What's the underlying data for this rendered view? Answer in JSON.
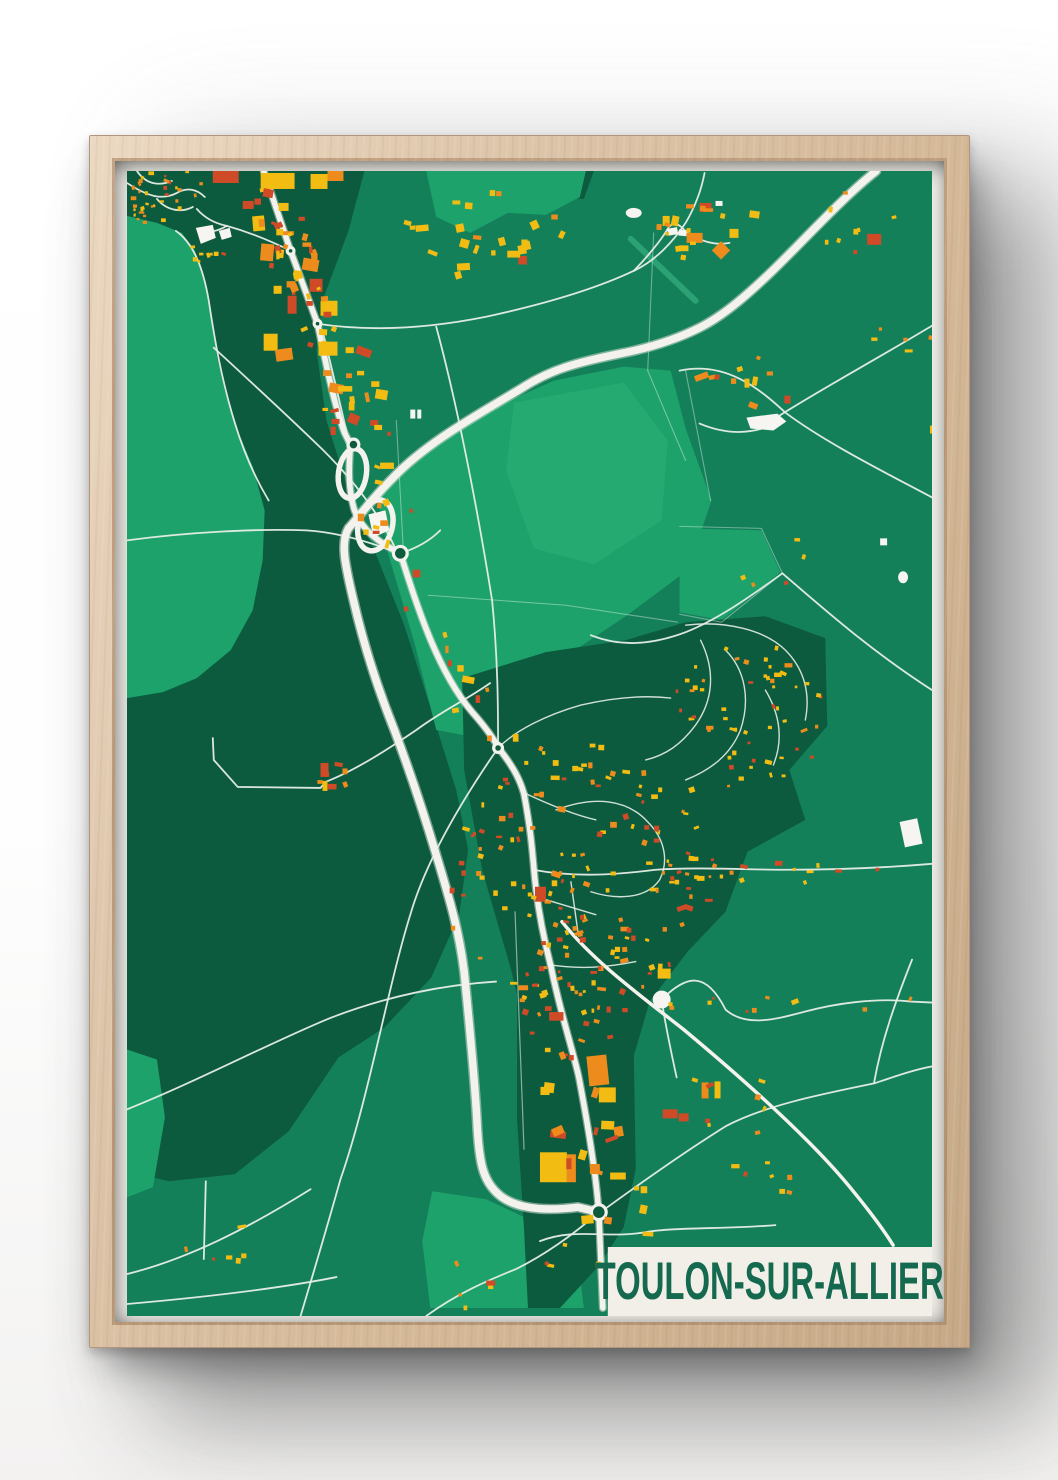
{
  "poster": {
    "title": "TOULON-SUR-ALLIER"
  },
  "palette": {
    "wall": "#ffffff",
    "frame_wood": "#d6bb9d",
    "paper": "#f2efe9",
    "title_green": "#15694e",
    "base": "#14805a",
    "dark": "#0c5b3e",
    "light": "#1da26b",
    "light2": "#25aa72",
    "road": "#f4f2ec",
    "road_casing": "#d3dad1",
    "road_minor": "#e7eee7",
    "boundary": "rgba(255,255,255,0.38)",
    "rail": "#dfe7df",
    "airstrip": "#35b07f",
    "white_landmark": "#f6f5f1",
    "yellow": "#f2bc13",
    "orange": "#ed8c1c",
    "red": "#cf4a26"
  },
  "map": {
    "w": 807,
    "h": 1147,
    "band": {
      "x": 482,
      "y": 1078,
      "w": 325,
      "h": 69
    },
    "polys": [
      {
        "tone": "dark",
        "pts": "0,0 238,0 222,60 196,130 190,180 200,250 222,320 250,385 278,455 305,540 330,620 342,680 333,745 305,808 258,858 212,888 162,962 108,1005 42,1012 0,1002"
      },
      {
        "tone": "dark",
        "pts": "390,0 468,0 458,28 396,22"
      },
      {
        "tone": "light",
        "pts": "0,45 30,52 55,62 68,80 76,103 84,140 90,185 98,220 110,258 126,296 138,340 136,390 126,440 104,480 70,508 36,522 0,528"
      },
      {
        "tone": "light",
        "pts": "300,0 460,0 454,26 420,44 382,42 344,62 310,46"
      },
      {
        "tone": "light",
        "pts": "250,320 298,282 356,242 428,210 498,196 545,200 560,258 586,330 562,400 500,446 440,486 396,540 342,566 310,560 288,472 262,384"
      },
      {
        "tone": "light2",
        "pts": "388,232 498,212 542,270 536,350 468,394 408,378 380,300"
      },
      {
        "tone": "light",
        "pts": "554,358 636,360 655,402 596,450 554,442"
      },
      {
        "tone": "light",
        "pts": "306,1022 360,1030 428,1062 452,1090 458,1139 304,1139 296,1072"
      },
      {
        "tone": "light",
        "pts": "0,880 30,890 38,948 26,1018 0,1028"
      },
      {
        "tone": "light",
        "pts": "436,826 472,830 470,848 438,845"
      },
      {
        "tone": "dark",
        "pts": "336,508 420,482 500,470 560,452 640,446 700,468 702,556 664,600 680,650 622,682 600,742 562,782 524,832 504,900 486,962 476,1022 440,1000 410,905 385,800 356,700 338,600"
      },
      {
        "tone": "dark",
        "pts": "391,742 500,742 508,880 510,1000 498,1058 472,1098 434,1139 402,1139 398,1060 391,950"
      }
    ],
    "roads": [
      {
        "t": "bnd",
        "d": "M 270 250 L 277 380"
      },
      {
        "t": "bnd",
        "d": "M 528 62 L 522 200 L 560 290"
      },
      {
        "t": "bnd",
        "d": "M 302 425 L 440 435 L 552 452"
      },
      {
        "t": "bnd",
        "d": "M 560 200 L 585 330"
      },
      {
        "t": "bnd",
        "d": "M 554 356 L 636 358 L 657 403 L 596 452 L 554 444"
      },
      {
        "t": "min",
        "d": "M 0 12 C 20 25 35 30 50 22 C 60 16 70 18 78 26"
      },
      {
        "t": "min",
        "d": "M 10 0 C 18 12 30 16 45 10"
      },
      {
        "t": "min",
        "d": "M 30 28 C 40 40 55 42 66 36"
      },
      {
        "t": "min",
        "d": "M 164 80 C 140 68 118 60 100 55 C 86 52 76 45 70 38"
      },
      {
        "t": "min",
        "d": "M 100 55 C 92 60 82 62 73 61"
      },
      {
        "t": "min",
        "d": "M 49 60 C 66 72 76 95 82 130 C 88 170 95 210 108 252 C 118 285 130 310 142 330"
      },
      {
        "t": "min",
        "d": "M 191 153 C 250 162 310 156 360 146 C 420 133 470 118 508 100 C 530 90 548 70 560 52 C 570 35 576 18 579 2"
      },
      {
        "t": "min",
        "d": "M 508 100 C 520 88 535 70 542 58 C 548 48 556 55 561 62 C 575 70 589 75 604 72"
      },
      {
        "t": "min",
        "d": "M 310 156 C 330 230 350 330 366 430 C 372 490 372 540 372 578"
      },
      {
        "t": "min",
        "d": "M 196 160 C 206 200 214 235 221 265"
      },
      {
        "t": "min",
        "d": "M 554 200 C 600 190 634 218 660 242 C 700 272 760 302 807 327"
      },
      {
        "t": "min",
        "d": "M 651 247 C 690 222 740 195 807 155"
      },
      {
        "t": "min",
        "d": "M 574 253 C 600 264 625 264 648 254"
      },
      {
        "t": "min",
        "d": "M 87 177 C 125 212 162 246 197 280 C 235 318 256 350 270 380"
      },
      {
        "t": "min",
        "d": "M 272 383 C 240 370 210 362 180 360 C 130 358 60 362 0 370"
      },
      {
        "t": "min",
        "d": "M 274 383 C 290 378 304 370 314 360"
      },
      {
        "t": "min",
        "d": "M 364 513 C 340 530 317 540 290 560 C 265 577 230 600 199 612 L 194 618 L 111 617 L 87 590 L 86 568"
      },
      {
        "t": "min",
        "d": "M 372 578 C 336 630 300 690 284 745 C 262 815 242 930 214 1010 C 200 1060 188 1100 174 1147"
      },
      {
        "t": "min",
        "d": "M 0 940 C 70 912 140 875 200 850 C 260 826 320 815 370 812"
      },
      {
        "t": "min",
        "d": "M 0 1105 C 60 1090 120 1060 184 1020"
      },
      {
        "t": "min",
        "d": "M 79 1012 L 77 1090"
      },
      {
        "t": "min",
        "d": "M 0 1135 C 80 1128 150 1120 210 1108"
      },
      {
        "t": "min",
        "d": "M 407 700 C 450 708 490 705 530 700 C 570 697 620 700 660 700 C 710 700 760 698 807 694"
      },
      {
        "t": "min",
        "d": "M 536 830 C 560 806 580 800 600 840 C 620 858 650 850 680 842 C 710 834 750 828 786 832 L 807 833"
      },
      {
        "t": "min",
        "d": "M 536 830 C 540 858 546 885 551 908"
      },
      {
        "t": "min",
        "d": "M 787 790 C 772 828 757 868 749 913"
      },
      {
        "t": "min",
        "d": "M 472 1045 C 520 1010 560 982 600 957 C 640 936 695 925 749 914 C 770 907 790 900 807 897"
      },
      {
        "t": "min",
        "d": "M 657 403 C 700 440 745 480 807 520"
      },
      {
        "t": "min",
        "d": "M 657 403 C 620 430 590 450 560 462 C 520 477 490 475 465 465"
      },
      {
        "t": "min",
        "d": "M 473 1043 C 448 1065 420 1085 390 1100 C 360 1112 330 1125 300 1147"
      },
      {
        "t": "min",
        "d": "M 414 1072 C 450 1058 480 1070 520 1063 C 548 1058 600 1060 650 1056"
      },
      {
        "t": "lane",
        "d": "M 560 455 C 600 450 640 460 660 480 C 680 500 685 525 680 550"
      },
      {
        "t": "lane",
        "d": "M 575 470 C 590 500 588 530 570 555 C 555 575 540 585 520 590"
      },
      {
        "t": "lane",
        "d": "M 600 480 C 620 500 625 530 615 560 C 605 585 585 600 560 610"
      },
      {
        "t": "lane",
        "d": "M 640 520 C 655 545 658 570 648 595"
      },
      {
        "t": "lane",
        "d": "M 396 622 C 430 638 452 646 470 650"
      },
      {
        "t": "lane",
        "d": "M 422 795 C 455 800 480 798 510 792"
      },
      {
        "t": "lane",
        "d": "M 430 640 C 470 625 502 630 522 652 C 540 670 543 692 534 710 C 520 730 490 730 465 722"
      },
      {
        "t": "lane",
        "d": "M 420 730 L 470 745"
      },
      {
        "t": "lane",
        "d": "M 445 712 L 452 762"
      },
      {
        "t": "lane",
        "d": "M 372 578 C 390 560 420 545 455 535 C 490 527 520 525 545 528"
      },
      {
        "t": "rail",
        "d": "M 389 742 L 398 980"
      },
      {
        "t": "med",
        "d": "M 436 752 C 468 792 512 824 558 860 C 618 910 688 972 728 1022 C 746 1044 758 1060 768 1076"
      },
      {
        "t": "st",
        "d": "M 137 0 L 164 80 L 191 153 C 200 196 208 235 218 262 L 224 274 C 222 300 222 320 228 340 C 236 360 252 372 274 383 C 292 440 312 502 346 542 C 362 560 368 570 374 580 C 388 598 394 610 398 624 C 404 656 406 676 408 700 C 411 736 417 766 425 797 C 435 846 447 880 453 908 C 460 945 465 975 468 998 C 471 1018 472 1032 473 1043 L 477 1139"
      },
      {
        "t": "hw",
        "d": "M 751 0 C 717 27 681 67 647 100 C 622 124 598 145 574 157 C 548 170 520 178 494 183 C 450 192 424 199 395 218 C 352 244 300 272 266 308 C 246 328 236 342 222 358 C 214 372 218 392 227 430 C 238 478 252 520 268 560 C 285 605 298 645 310 685 C 324 731 333 762 338 802 C 344 862 349 915 351 955 C 353 995 357 1014 376 1028 C 396 1042 428 1041 452 1038 L 473 1043"
      }
    ],
    "airstrip": [
      505,
      68,
      570,
      130
    ],
    "ovals": [
      [
        226,
        303,
        14,
        25,
        8
      ],
      [
        249,
        355,
        17,
        26,
        15
      ]
    ],
    "rings": [
      [
        164,
        80,
        5
      ],
      [
        191,
        153,
        5
      ],
      [
        227,
        274,
        7
      ],
      [
        274,
        383,
        8.5
      ],
      [
        372,
        578,
        6
      ],
      [
        473,
        1043,
        9
      ]
    ],
    "white": [
      {
        "k": "poly",
        "v": "69,57 86,54 89,67 74,73"
      },
      {
        "k": "poly",
        "v": "92,60 103,57 105,66 95,69"
      },
      {
        "k": "poly",
        "v": "242,344 259,340 263,360 247,367"
      },
      {
        "k": "ellipse",
        "v": [
          508,
          42,
          8,
          5,
          0
        ]
      },
      {
        "k": "rect",
        "v": [
          542,
          57,
          10,
          7,
          -10
        ]
      },
      {
        "k": "rect",
        "v": [
          553,
          59,
          8,
          6,
          5
        ]
      },
      {
        "k": "rect",
        "v": [
          590,
          30,
          7,
          5,
          0
        ]
      },
      {
        "k": "poly",
        "v": "621,247 652,243 661,251 648,260 625,258"
      },
      {
        "k": "rect",
        "v": [
          755,
          368,
          7,
          7,
          0
        ]
      },
      {
        "k": "ellipse",
        "v": [
          778,
          407,
          5,
          6,
          0
        ]
      },
      {
        "k": "circle",
        "v": [
          536,
          830,
          9
        ]
      },
      {
        "k": "rect",
        "v": [
          777,
          650,
          18,
          26,
          -12
        ]
      },
      {
        "k": "rect",
        "v": [
          284,
          239,
          5,
          9,
          0
        ]
      },
      {
        "k": "rect",
        "v": [
          291,
          239,
          4,
          9,
          0
        ]
      }
    ],
    "buildings": [
      [
        86,
        0,
        26,
        12,
        "red",
        0
      ],
      [
        134,
        2,
        34,
        16,
        "yellow",
        0
      ],
      [
        184,
        3,
        17,
        15,
        "yellow",
        0
      ],
      [
        201,
        0,
        16,
        10,
        "orange",
        0
      ],
      [
        116,
        30,
        11,
        8,
        "red",
        0
      ],
      [
        152,
        32,
        10,
        8,
        "yellow",
        0
      ],
      [
        126,
        45,
        12,
        15,
        "yellow",
        -5
      ],
      [
        134,
        73,
        13,
        17,
        "orange",
        5
      ],
      [
        147,
        115,
        8,
        8,
        "yellow",
        0
      ],
      [
        161,
        125,
        9,
        18,
        "red",
        0
      ],
      [
        176,
        88,
        16,
        12,
        "orange",
        10
      ],
      [
        183,
        108,
        13,
        13,
        "red",
        0
      ],
      [
        194,
        130,
        17,
        15,
        "yellow",
        0
      ],
      [
        137,
        163,
        14,
        17,
        "yellow",
        0
      ],
      [
        149,
        178,
        17,
        12,
        "orange",
        -8
      ],
      [
        192,
        171,
        19,
        14,
        "yellow",
        0
      ],
      [
        574,
        32,
        12,
        9,
        "red",
        0
      ],
      [
        537,
        45,
        7,
        10,
        "yellow",
        0
      ],
      [
        546,
        45,
        7,
        10,
        "yellow",
        12
      ],
      [
        561,
        62,
        16,
        10,
        "orange",
        0
      ],
      [
        589,
        73,
        13,
        13,
        "orange",
        45
      ],
      [
        604,
        58,
        9,
        9,
        "yellow",
        0
      ],
      [
        624,
        40,
        10,
        7,
        "yellow",
        8
      ],
      [
        742,
        63,
        14,
        11,
        "red",
        0
      ],
      [
        569,
        203,
        14,
        6,
        "orange",
        -20
      ],
      [
        619,
        208,
        5,
        9,
        "yellow",
        0
      ],
      [
        627,
        206,
        5,
        9,
        "yellow",
        10
      ],
      [
        659,
        225,
        6,
        8,
        "red",
        0
      ],
      [
        409,
        717,
        11,
        15,
        "red",
        0
      ],
      [
        462,
        886,
        20,
        30,
        "orange",
        -6
      ],
      [
        473,
        918,
        17,
        15,
        "yellow",
        0
      ],
      [
        414,
        983,
        27,
        30,
        "yellow",
        0
      ],
      [
        441,
        985,
        9,
        28,
        "orange",
        0
      ],
      [
        576,
        913,
        7,
        16,
        "orange",
        0
      ],
      [
        589,
        912,
        6,
        17,
        "yellow",
        0
      ],
      [
        537,
        940,
        15,
        9,
        "red",
        0
      ],
      [
        553,
        944,
        10,
        8,
        "red",
        0
      ],
      [
        532,
        799,
        13,
        10,
        "yellow",
        0
      ],
      [
        194,
        593,
        8,
        14,
        "red",
        0
      ],
      [
        196,
        611,
        5,
        10,
        "yellow",
        0
      ],
      [
        805,
        255,
        5,
        8,
        "yellow",
        0
      ]
    ],
    "clusters": [
      {
        "seed": 11,
        "cx": 38,
        "cy": 16,
        "rx": 46,
        "ry": 26,
        "n": 26,
        "s": [
          2,
          4.5
        ],
        "pal": "mix"
      },
      {
        "seed": 12,
        "cx": 18,
        "cy": 38,
        "rx": 30,
        "ry": 22,
        "n": 14,
        "s": [
          2,
          4
        ],
        "pal": "mix"
      },
      {
        "seed": 13,
        "cx": 76,
        "cy": 78,
        "rx": 22,
        "ry": 14,
        "n": 9,
        "s": [
          2.5,
          5
        ],
        "pal": "yellow"
      },
      {
        "seed": 14,
        "line": [
          140,
          20,
          165,
          90
        ],
        "sp": 24,
        "n": 16,
        "s": [
          3,
          9
        ],
        "pal": "mix"
      },
      {
        "seed": 15,
        "line": [
          165,
          90,
          195,
          160
        ],
        "sp": 28,
        "n": 18,
        "s": [
          3,
          9
        ],
        "pal": "mix"
      },
      {
        "seed": 16,
        "line": [
          195,
          160,
          228,
          260
        ],
        "sp": 28,
        "n": 20,
        "s": [
          3,
          10
        ],
        "pal": "mix"
      },
      {
        "seed": 17,
        "line": [
          228,
          260,
          262,
          380
        ],
        "sp": 32,
        "n": 14,
        "s": [
          3,
          9
        ],
        "pal": "mix"
      },
      {
        "seed": 18,
        "line": [
          272,
          383,
          372,
          578
        ],
        "sp": 24,
        "n": 12,
        "s": [
          3,
          8
        ],
        "pal": "mix"
      },
      {
        "seed": 19,
        "cx": 350,
        "cy": 60,
        "rx": 85,
        "ry": 42,
        "n": 24,
        "s": [
          4,
          9
        ],
        "pal": "yellow"
      },
      {
        "seed": 20,
        "cx": 560,
        "cy": 55,
        "rx": 45,
        "ry": 35,
        "n": 12,
        "s": [
          3,
          6
        ],
        "pal": "warm"
      },
      {
        "seed": 21,
        "cx": 745,
        "cy": 55,
        "rx": 55,
        "ry": 45,
        "n": 8,
        "s": [
          3,
          6
        ],
        "pal": "warm"
      },
      {
        "seed": 22,
        "cx": 455,
        "cy": 700,
        "rx": 145,
        "ry": 130,
        "n": 140,
        "s": [
          2.5,
          6
        ],
        "pal": "mix"
      },
      {
        "seed": 23,
        "cx": 625,
        "cy": 545,
        "rx": 80,
        "ry": 75,
        "n": 55,
        "s": [
          2.5,
          5
        ],
        "pal": "warm"
      },
      {
        "seed": 24,
        "cx": 448,
        "cy": 810,
        "rx": 60,
        "ry": 80,
        "n": 40,
        "s": [
          2.5,
          6
        ],
        "pal": "mix"
      },
      {
        "seed": 25,
        "line": [
          500,
          697,
          790,
          700
        ],
        "sp": 12,
        "n": 20,
        "s": [
          2.5,
          5
        ],
        "pal": "warm"
      },
      {
        "seed": 26,
        "line": [
          404,
          855,
          495,
          1055
        ],
        "sp": 36,
        "n": 22,
        "s": [
          4,
          11
        ],
        "pal": "mix"
      },
      {
        "seed": 27,
        "cx": 480,
        "cy": 1090,
        "rx": 75,
        "ry": 28,
        "n": 9,
        "s": [
          3,
          7
        ],
        "pal": "mix"
      },
      {
        "seed": 28,
        "cx": 203,
        "cy": 605,
        "rx": 16,
        "ry": 14,
        "n": 6,
        "s": [
          3,
          6
        ],
        "pal": "red"
      },
      {
        "seed": 29,
        "cx": 95,
        "cy": 1075,
        "rx": 45,
        "ry": 30,
        "n": 6,
        "s": [
          3,
          6
        ],
        "pal": "mix"
      },
      {
        "seed": 30,
        "cx": 600,
        "cy": 935,
        "rx": 55,
        "ry": 35,
        "n": 8,
        "s": [
          3,
          6
        ],
        "pal": "warm"
      },
      {
        "seed": 31,
        "cx": 625,
        "cy": 1015,
        "rx": 45,
        "ry": 25,
        "n": 7,
        "s": [
          3,
          6
        ],
        "pal": "warm"
      },
      {
        "seed": 32,
        "cx": 660,
        "cy": 395,
        "rx": 50,
        "ry": 30,
        "n": 5,
        "s": [
          3,
          5
        ],
        "pal": "warm"
      },
      {
        "seed": 33,
        "cx": 620,
        "cy": 212,
        "rx": 45,
        "ry": 28,
        "n": 7,
        "s": [
          3,
          6
        ],
        "pal": "warm"
      },
      {
        "seed": 34,
        "cx": 775,
        "cy": 168,
        "rx": 30,
        "ry": 20,
        "n": 5,
        "s": [
          3,
          5
        ],
        "pal": "warm"
      },
      {
        "seed": 35,
        "cx": 330,
        "cy": 1115,
        "rx": 45,
        "ry": 25,
        "n": 5,
        "s": [
          3,
          6
        ],
        "pal": "mix"
      },
      {
        "seed": 36,
        "line": [
          536,
          830,
          786,
          832
        ],
        "sp": 10,
        "n": 10,
        "s": [
          2.5,
          5
        ],
        "pal": "warm"
      }
    ]
  }
}
